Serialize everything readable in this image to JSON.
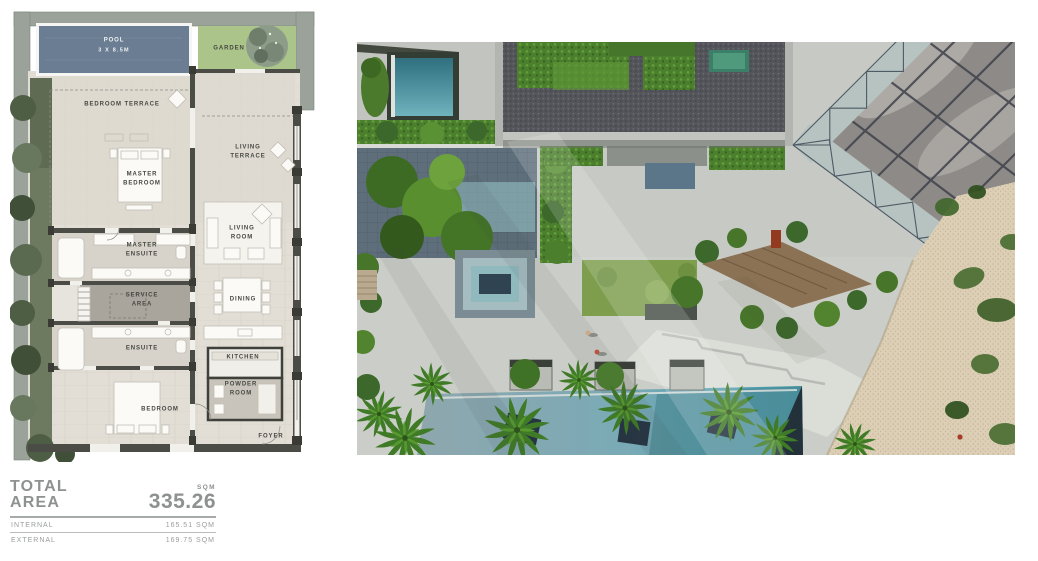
{
  "floor_plan": {
    "pool": {
      "name": "POOL",
      "size": "3 X 8.5M"
    },
    "garden": "GARDEN",
    "rooms": {
      "bedroom_terrace": "BEDROOM TERRACE",
      "living_terrace": "LIVING TERRACE",
      "master_bedroom": "MASTER BEDROOM",
      "living_room": "LIVING ROOM",
      "master_ensuite": "MASTER ENSUITE",
      "service_area": "SERVICE AREA",
      "dining": "DINING",
      "ensuite": "ENSUITE",
      "kitchen": "KITCHEN",
      "powder_room": "POWDER ROOM",
      "bedroom": "BEDROOM",
      "foyer": "FOYER"
    }
  },
  "area_summary": {
    "title_line1": "TOTAL",
    "title_line2": "AREA",
    "unit": "SQM",
    "total": "335.26",
    "rows": [
      {
        "label": "INTERNAL",
        "value": "165.51 SQM"
      },
      {
        "label": "EXTERNAL",
        "value": "169.75 SQM"
      }
    ]
  },
  "colors": {
    "plan_pool": "#6a7d92",
    "plan_garden": "#abc489",
    "plan_wall_gray": "#9aa29a",
    "photo_pool_teal": "#4d8b96",
    "photo_sand": "#dccfb6",
    "hedge_green": "#4e8030",
    "text_gray": "#8d9190"
  }
}
